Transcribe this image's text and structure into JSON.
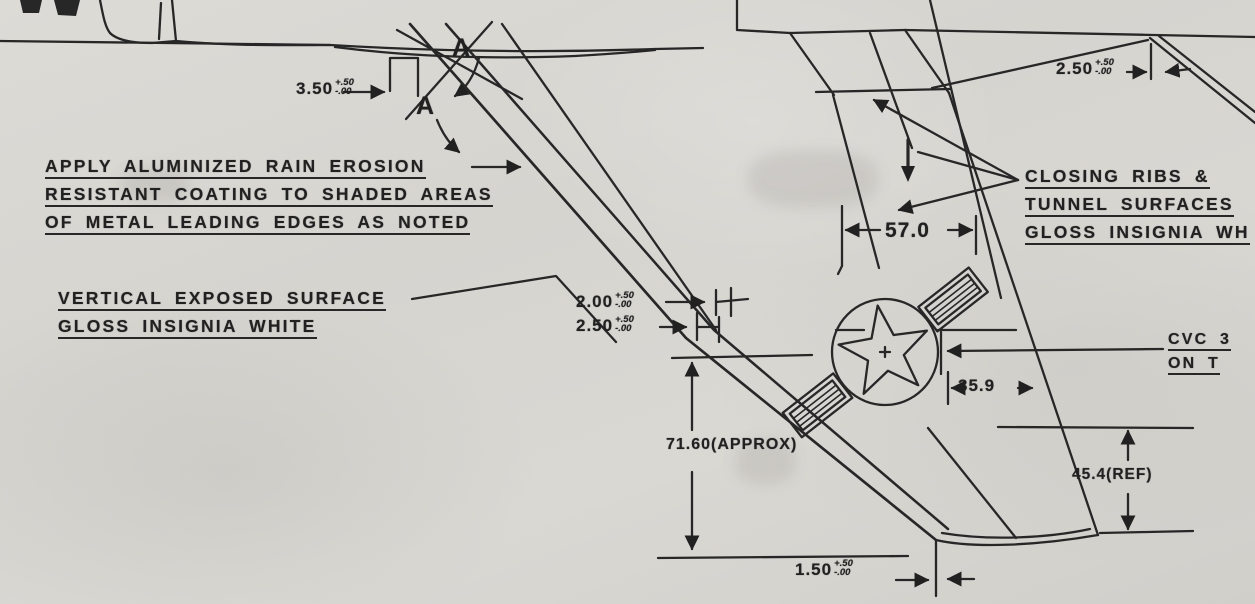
{
  "drawing": {
    "type": "engineering-blueprint",
    "subject": "aircraft fin / ventral fin finish and dimension detail",
    "colors": {
      "paper": "#d7d5d0",
      "ink": "#242424"
    },
    "notes": {
      "rain_erosion": {
        "line1": "APPLY ALUMINIZED RAIN EROSION",
        "line2": "RESISTANT COATING TO SHADED AREAS",
        "line3": "OF METAL LEADING EDGES AS NOTED"
      },
      "vertical_surface": {
        "line1": "VERTICAL EXPOSED SURFACE",
        "line2": "GLOSS INSIGNIA WHITE"
      },
      "closing_ribs": {
        "line1": "CLOSING RIBS &",
        "line2": "TUNNEL SURFACES",
        "line3": "GLOSS INSIGNIA WH"
      },
      "cvc": {
        "line1": "CVC 3",
        "line2": "ON T"
      }
    },
    "dimensions": {
      "d350": {
        "value": "3.50",
        "plus": "+.50",
        "minus": "-.00"
      },
      "d250top": {
        "value": "2.50",
        "plus": "+.50",
        "minus": "-.00"
      },
      "d200": {
        "value": "2.00",
        "plus": "+.50",
        "minus": "-.00"
      },
      "d250mid": {
        "value": "2.50",
        "plus": "+.50",
        "minus": "-.00"
      },
      "d570": {
        "value": "57.0"
      },
      "d7160": {
        "value": "71.60(APPROX)"
      },
      "d359": {
        "value": "35.9"
      },
      "d454": {
        "value": "45.4(REF)"
      },
      "d150": {
        "value": "1.50",
        "plus": "+.50",
        "minus": "-.00"
      }
    },
    "section_marks": {
      "a1": "A",
      "a2": "A"
    },
    "symbols": {
      "star_insignia": "us-national-star-and-bars"
    }
  }
}
